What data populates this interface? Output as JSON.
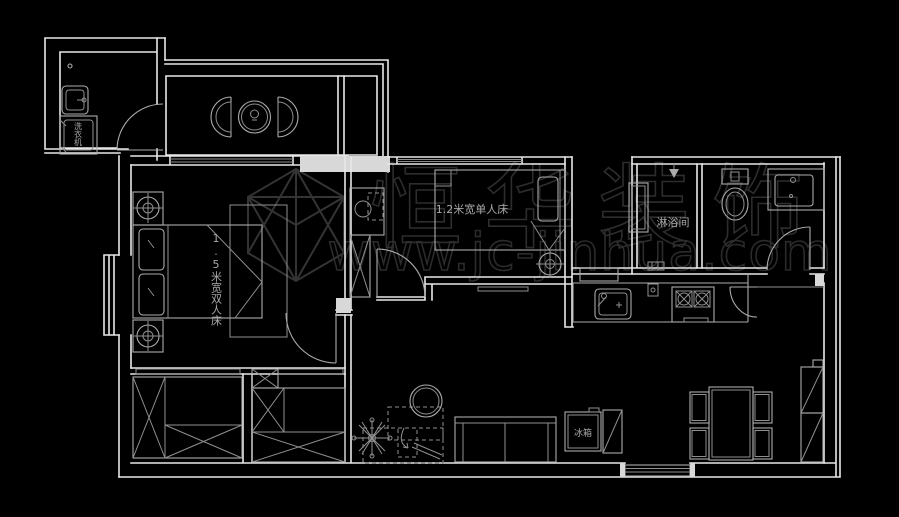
{
  "canvas": {
    "width": 899,
    "height": 517,
    "background": "#000000",
    "wall_color": "#e8e8e8",
    "furniture_color": "#ababab",
    "label_color": "#a8a8a8",
    "watermark_color": "#343434"
  },
  "labels": {
    "washing_machine": "洗衣机",
    "master_bed": "1.5米宽双人床",
    "single_bed": "1.2米宽单人床",
    "shower_room": "淋浴间",
    "fridge": "冰箱"
  },
  "watermark": {
    "brand": "恒华装饰",
    "url": "www.jc-jinhua.com"
  }
}
